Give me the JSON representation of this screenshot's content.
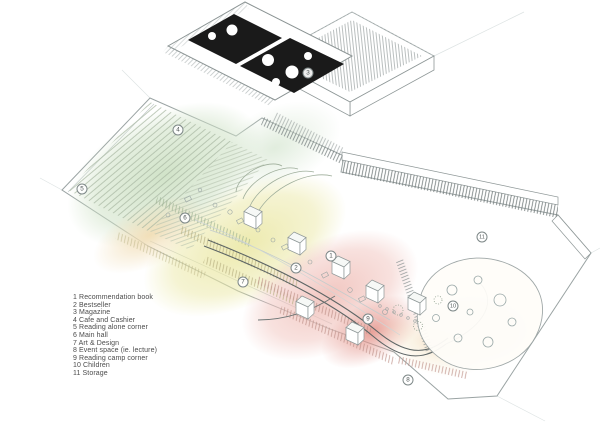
{
  "canvas": {
    "background": "#ffffff"
  },
  "plan": {
    "type": "axonometric-floor-plan",
    "markers": [
      {
        "num": "1",
        "x": 331,
        "y": 256
      },
      {
        "num": "2",
        "x": 296,
        "y": 268
      },
      {
        "num": "3",
        "x": 308,
        "y": 73
      },
      {
        "num": "4",
        "x": 178,
        "y": 130
      },
      {
        "num": "5",
        "x": 82,
        "y": 189
      },
      {
        "num": "6",
        "x": 185,
        "y": 218
      },
      {
        "num": "7",
        "x": 243,
        "y": 282
      },
      {
        "num": "8",
        "x": 408,
        "y": 380
      },
      {
        "num": "9",
        "x": 368,
        "y": 319
      },
      {
        "num": "10",
        "x": 453,
        "y": 306
      },
      {
        "num": "11",
        "x": 482,
        "y": 237
      }
    ],
    "zone_colors": {
      "reading_steps_green": "#cfe2c6",
      "main_hall_yellow": "#ebe8a6",
      "art_design_pink": "#f1c4be",
      "event_red": "#e5978e",
      "cafe_orange": "#f1dcb2",
      "dark_rooms": "#1a1a1a"
    }
  },
  "legend": {
    "items": [
      {
        "num": "1",
        "label": "Recommendation book"
      },
      {
        "num": "2",
        "label": "Bestseller"
      },
      {
        "num": "3",
        "label": "Magazine"
      },
      {
        "num": "4",
        "label": "Cafe and Cashier"
      },
      {
        "num": "5",
        "label": "Reading alone corner"
      },
      {
        "num": "6",
        "label": "Main hall"
      },
      {
        "num": "7",
        "label": "Art & Design"
      },
      {
        "num": "8",
        "label": "Event space (ie. lecture)"
      },
      {
        "num": "9",
        "label": "Reading camp corner"
      },
      {
        "num": "10",
        "label": "Children"
      },
      {
        "num": "11",
        "label": "Storage"
      }
    ]
  }
}
